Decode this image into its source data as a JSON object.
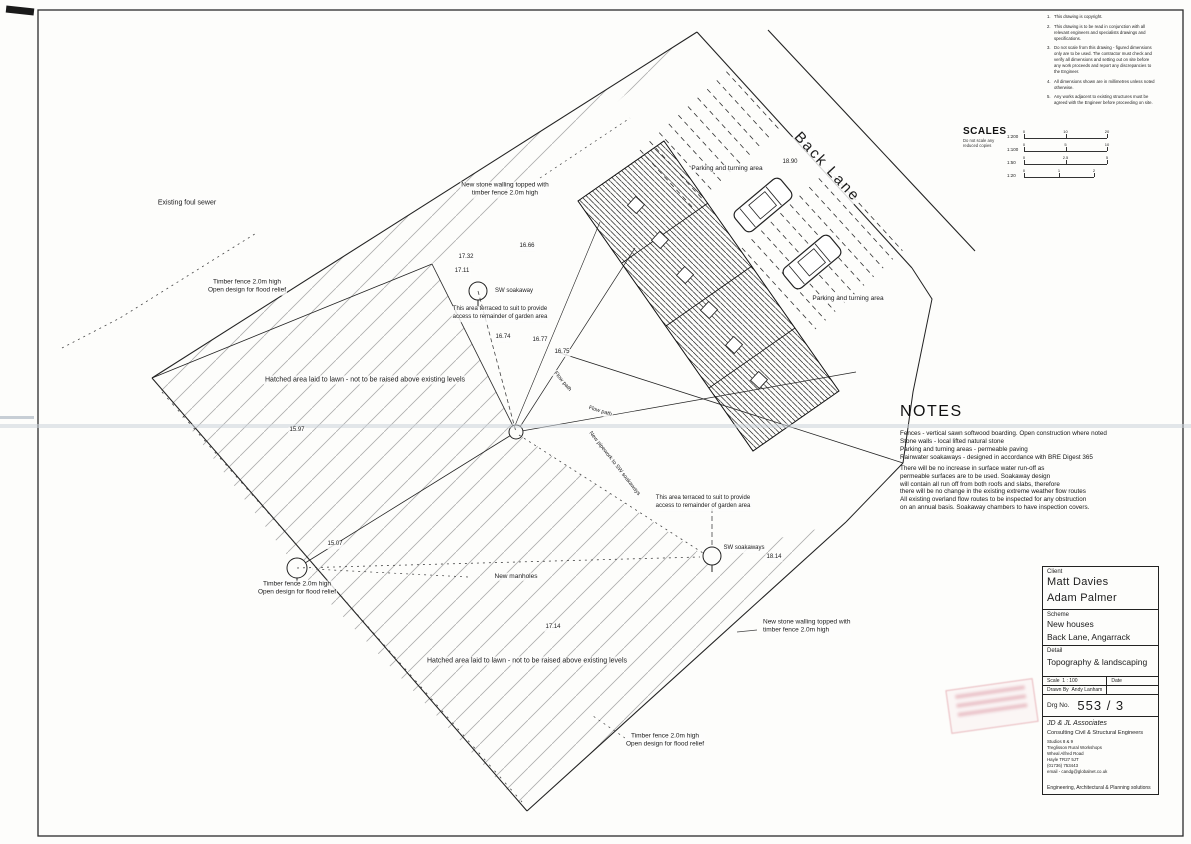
{
  "sheet": {
    "title": "Topography & landscaping site plan"
  },
  "general_notes": {
    "items": [
      "This drawing is copyright.",
      "This drawing is to be read in conjunction with all relevant engineers and specialists drawings and specifications.",
      "Do not scale from this drawing - figured dimensions only are to be used. The contractor must check and verify all dimensions and setting out on site before any work proceeds and report any discrepancies to the Engineer.",
      "All dimensions shown are in millimetres unless noted otherwise.",
      "Any works adjacent to existing structures must be agreed with the Engineer before proceeding on site."
    ]
  },
  "scales": {
    "title": "SCALES",
    "note_lines": [
      "Do not scale any",
      "reduced copies"
    ],
    "bars": [
      {
        "label": "1:200",
        "ticks": [
          "0",
          "10",
          "20"
        ]
      },
      {
        "label": "1:100",
        "ticks": [
          "0",
          "5",
          "10"
        ]
      },
      {
        "label": "1:50",
        "ticks": [
          "0",
          "2.5",
          "5"
        ]
      },
      {
        "label": "1:20",
        "ticks": [
          "0",
          "1",
          "2"
        ]
      }
    ]
  },
  "notes": {
    "title": "NOTES",
    "lines": [
      "Fences - vertical sawn softwood boarding. Open construction where noted",
      "Stone walls - local lifted natural stone",
      "Parking and turning areas - permeable paving",
      "Rainwater soakaways - designed in accordance with BRE Digest 365",
      "There will be no increase in surface water run-off as",
      "permeable surfaces are to be used. Soakaway design",
      "will contain all run off from both roofs and slabs, therefore",
      "there will be no change in the existing extreme weather flow routes",
      "All existing overland flow routes to be inspected for any obstruction",
      "on an annual basis. Soakaway chambers to have inspection covers."
    ]
  },
  "title_block": {
    "client_label": "Client",
    "client_lines": [
      "Matt Davies",
      "Adam Palmer"
    ],
    "scheme_label": "Scheme",
    "scheme_lines": [
      "New houses",
      "Back Lane, Angarrack"
    ],
    "detail_label": "Detail",
    "detail": "Topography & landscaping",
    "scale_label": "Scale",
    "scale_value": "1 : 100",
    "date_label": "Date",
    "date_value": "",
    "drawn_by_label": "Drawn By",
    "drawn_by": "Andy Lanham",
    "drg_no_label": "Drg No.",
    "drg_no": "553 / 3",
    "firm_name": "JD & JL Associates",
    "firm_type": "Consulting Civil & Structural Engineers",
    "firm_address": [
      "Studios 8 & 9",
      "Treglisson Rural Workshops",
      "Wheal Alfred Road",
      "Hayle TR27 5JT",
      "(01736) 753443",
      "email - candg@globalnet.co.uk"
    ],
    "firm_tagline": "Engineering, Architectural & Planning solutions"
  },
  "plan": {
    "labels": [
      {
        "n": "sewer-note",
        "t": "Existing foul sewer",
        "x": 187,
        "y": 203,
        "s": 7
      },
      {
        "n": "fence-note",
        "t": "Timber fence 2.0m high\nOpen design for flood relief",
        "x": 247,
        "y": 287,
        "s": 6.5
      },
      {
        "n": "wall-note",
        "t": "New stone walling topped with\ntimber fence 2.0m high",
        "x": 505,
        "y": 190,
        "s": 6.5
      },
      {
        "n": "lawn-note",
        "t": "Hatched area laid to lawn - not to be raised above existing levels",
        "x": 365,
        "y": 380,
        "s": 7
      },
      {
        "n": "spot-level",
        "t": "17.32",
        "x": 466,
        "y": 258,
        "s": 6
      },
      {
        "n": "spot-level",
        "t": "16.66",
        "x": 527,
        "y": 247,
        "s": 6
      },
      {
        "n": "spot-level",
        "t": "17.11",
        "x": 462,
        "y": 272,
        "s": 6
      },
      {
        "n": "soakaway-label",
        "t": "SW soakaway",
        "x": 514,
        "y": 292,
        "s": 6
      },
      {
        "n": "garden-access-note",
        "t": "This area terraced to suit to provide\naccess to remainder of garden area",
        "x": 500,
        "y": 314,
        "s": 6
      },
      {
        "n": "spot-level",
        "t": "16.74",
        "x": 503,
        "y": 338,
        "s": 6
      },
      {
        "n": "spot-level",
        "t": "16.77",
        "x": 540,
        "y": 341,
        "s": 6
      },
      {
        "n": "spot-level",
        "t": "16.75",
        "x": 562,
        "y": 353,
        "s": 6
      },
      {
        "n": "spot-level",
        "t": "15.97",
        "x": 297,
        "y": 431,
        "s": 6
      },
      {
        "n": "spot-level",
        "t": "15.07",
        "x": 335,
        "y": 545,
        "s": 6
      },
      {
        "n": "manhole-note",
        "t": "New manholes",
        "x": 516,
        "y": 577,
        "s": 6.5
      },
      {
        "n": "fence-note",
        "t": "Timber fence 2.0m high\nOpen design for flood relief",
        "x": 297,
        "y": 589,
        "s": 6.5
      },
      {
        "n": "garden-access-note",
        "t": "This area terraced to suit to provide\naccess to remainder of garden area",
        "x": 703,
        "y": 503,
        "s": 6
      },
      {
        "n": "soakaway-label",
        "t": "SW soakaways",
        "x": 744,
        "y": 549,
        "s": 6
      },
      {
        "n": "spot-level",
        "t": "18.14",
        "x": 774,
        "y": 558,
        "s": 6
      },
      {
        "n": "spot-level",
        "t": "17.14",
        "x": 553,
        "y": 628,
        "s": 6
      },
      {
        "n": "lawn-note",
        "t": "Hatched area laid to lawn - not to be raised above existing levels",
        "x": 527,
        "y": 661,
        "s": 7
      },
      {
        "n": "wall-note",
        "t": "New stone walling topped with\ntimber fence 2.0m high",
        "x": 762,
        "y": 627,
        "s": 6.5,
        "a": "left"
      },
      {
        "n": "fence-note",
        "t": "Timber fence 2.0m high\nOpen design for flood relief",
        "x": 665,
        "y": 741,
        "s": 6.5
      },
      {
        "n": "parking-area-label",
        "t": "Parking and turning area",
        "x": 727,
        "y": 169,
        "s": 6.5
      },
      {
        "n": "parking-area-label",
        "t": "Parking and turning area",
        "x": 848,
        "y": 299,
        "s": 6.5
      },
      {
        "n": "road-name",
        "t": "Back Lane",
        "x": 827,
        "y": 167,
        "s": 15,
        "r": 47,
        "sp": 2
      },
      {
        "n": "spot-level",
        "t": "18.90",
        "x": 790,
        "y": 163,
        "s": 6
      },
      {
        "n": "flow-path-label",
        "t": "Flow path",
        "x": 562,
        "y": 382,
        "s": 5.5,
        "r": 50
      },
      {
        "n": "flow-path-label",
        "t": "Flow path",
        "x": 600,
        "y": 412,
        "s": 5.5,
        "r": 17
      },
      {
        "n": "pipework-label",
        "t": "New pipework to SW soakaways",
        "x": 614,
        "y": 464,
        "s": 5.5,
        "r": 52
      }
    ]
  }
}
